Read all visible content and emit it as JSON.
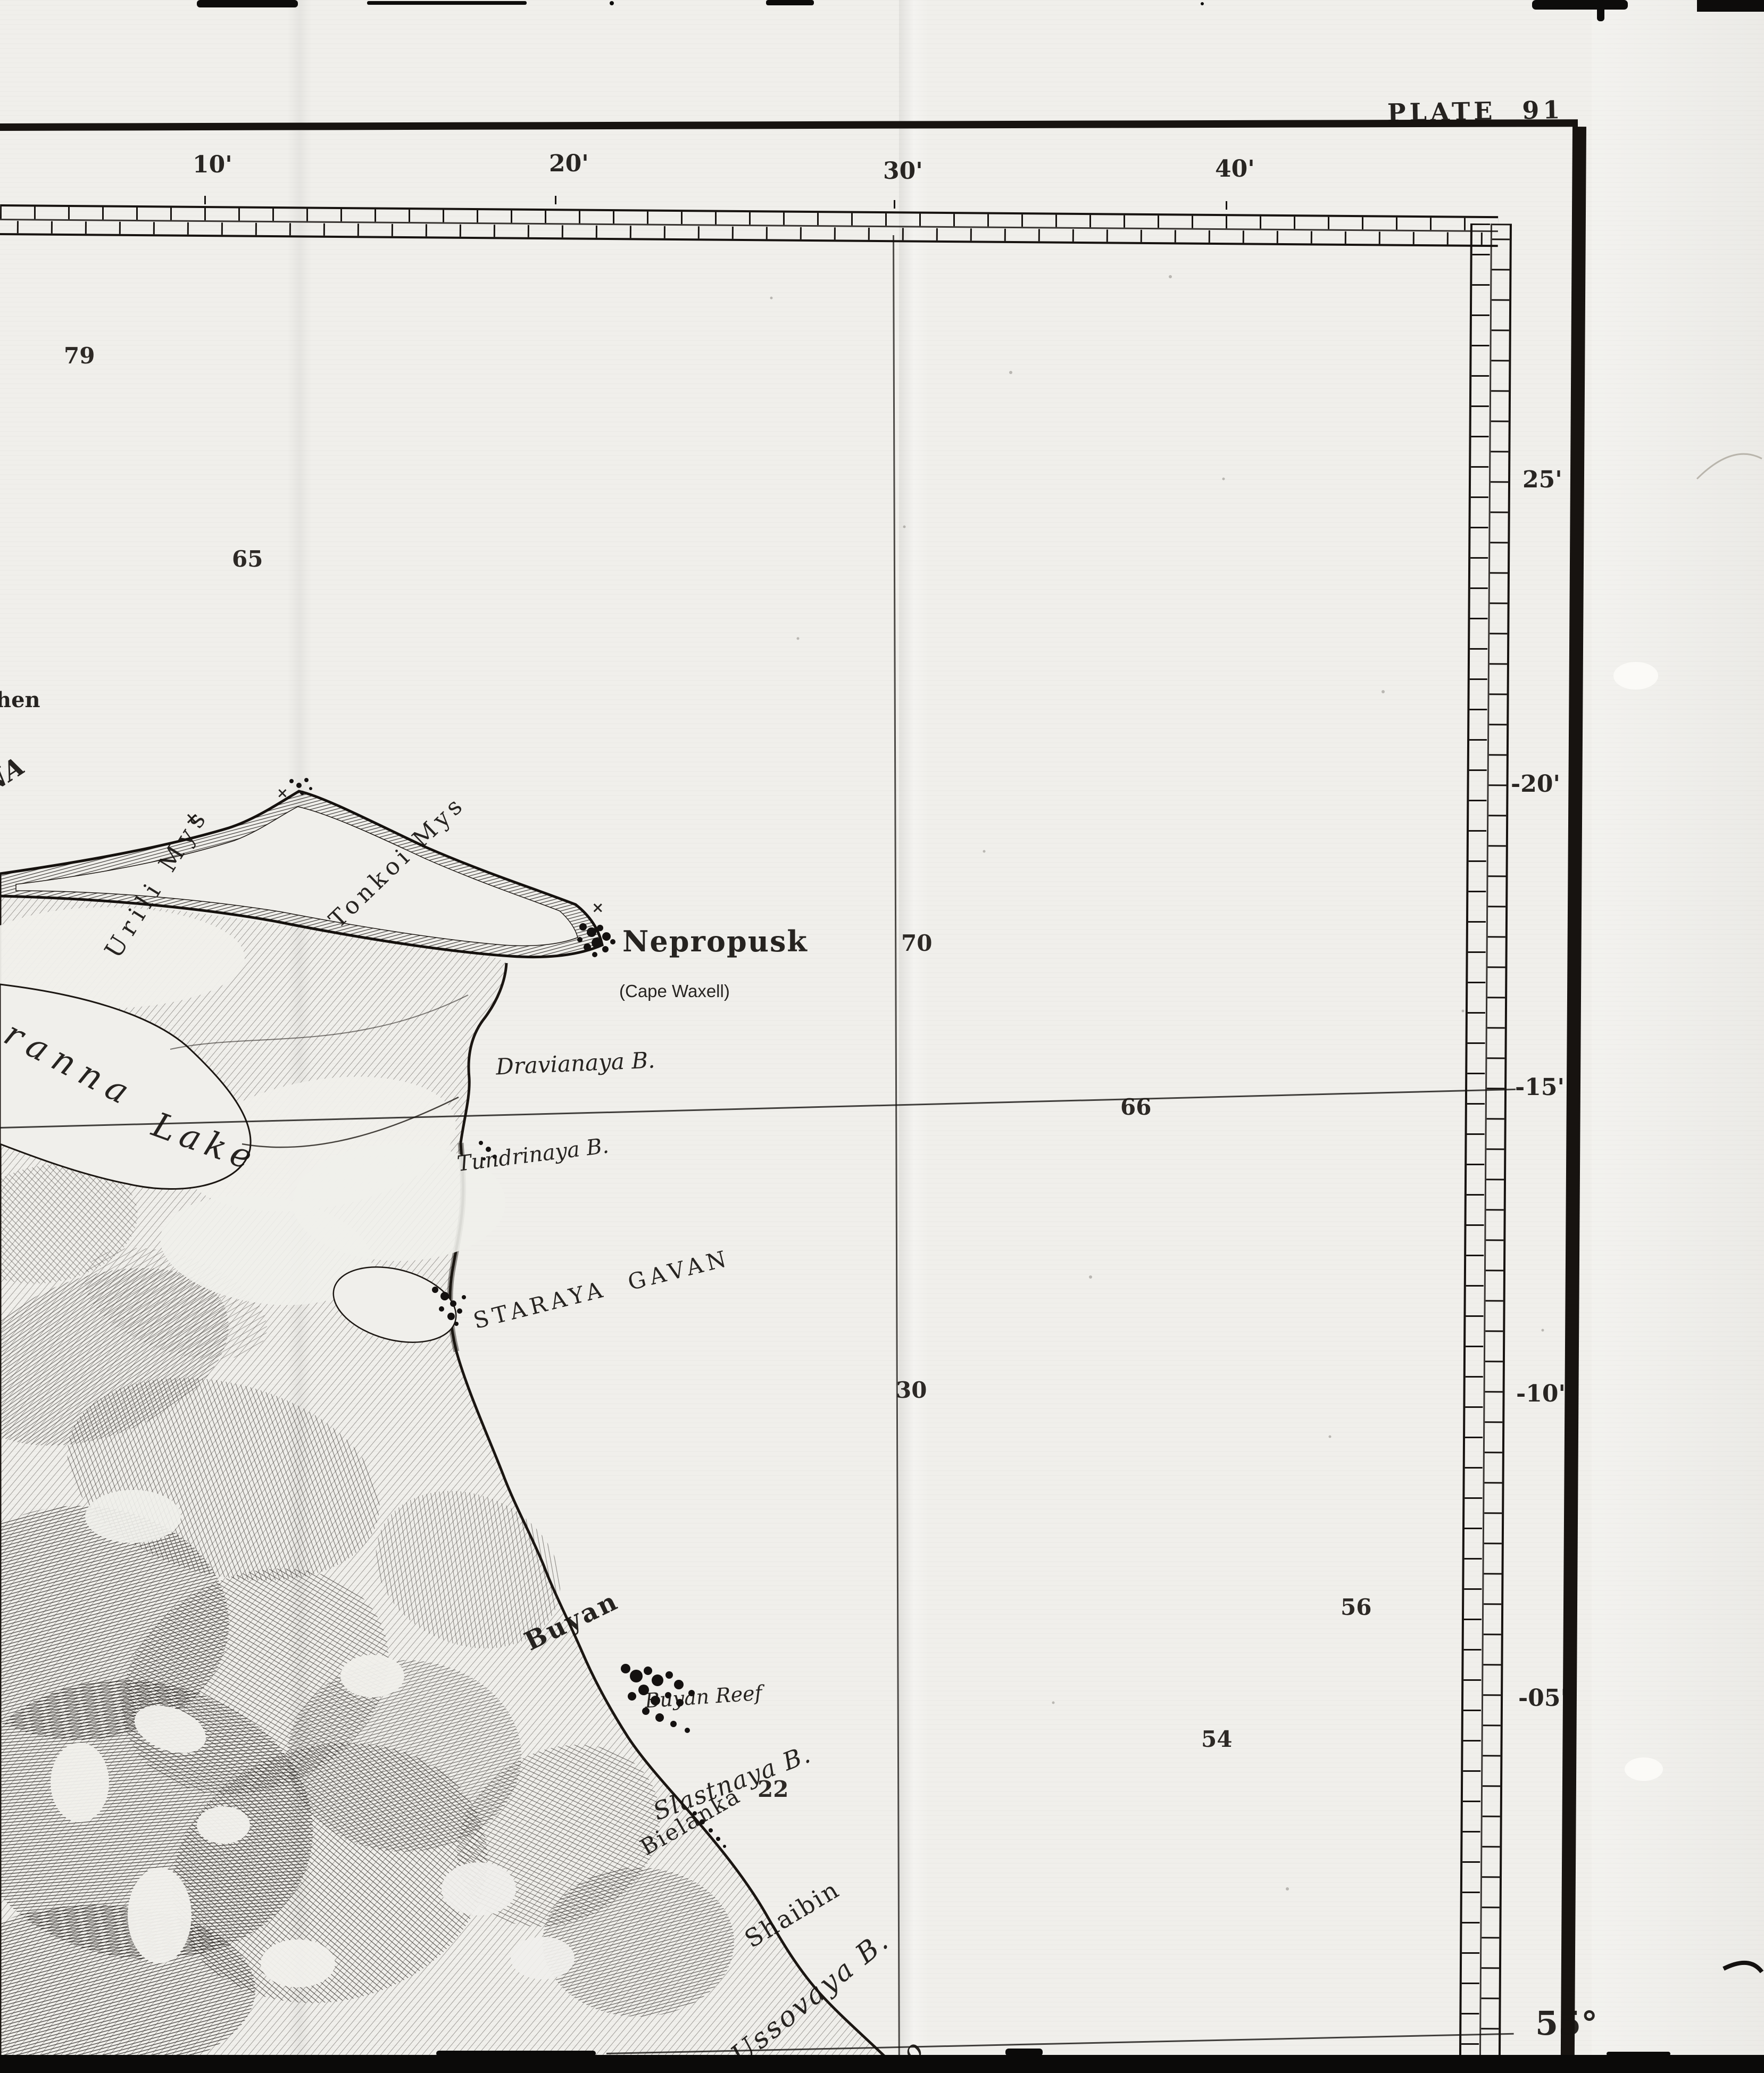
{
  "plate_label": "PLATE 91",
  "graticule": {
    "top_ticks": [
      "10'",
      "20'",
      "30'",
      "40'"
    ],
    "right_ticks": [
      "25'",
      "-20'",
      "-15'",
      "-10'",
      "-05'"
    ],
    "bottom_right_latitude": "55°"
  },
  "soundings": {
    "s79": "79",
    "s65": "65",
    "s70": "70",
    "s66": "66",
    "s30": "30",
    "s56": "56",
    "s54": "54",
    "s22": "22"
  },
  "places": {
    "nepropusk": "Nepropusk",
    "cape_waxell": "(Cape Waxell)",
    "dravianaya_b": "Dravianaya B.",
    "tundrinaya_b": "Tundrinaya B.",
    "staraya_gavan": "STARAYA GAVAN",
    "urili_mys": "Urili Mys",
    "tonkoi_mys": "Tonkoi Mys",
    "ranna": "ranna",
    "lake": "Lake",
    "buyan": "Buyan",
    "buyan_reef": "Buyan Reef",
    "bielanka": "Bielanka",
    "slastnaya_b": "Slastnaya B.",
    "shaibin": "Shaibin",
    "ussovaya_b": "Ussovaya B.",
    "lavino": "lavino",
    "or_fragment": "OR",
    "akh_fragment": "akh",
    "hen_fragment": "hen",
    "na_fragment": "NA",
    "ys_fragment": "ys"
  },
  "symbols": {
    "x_mark": "×"
  },
  "colors": {
    "paper": "#f0efeb",
    "ink": "#171310",
    "shadow_band": "#0b0a09"
  }
}
